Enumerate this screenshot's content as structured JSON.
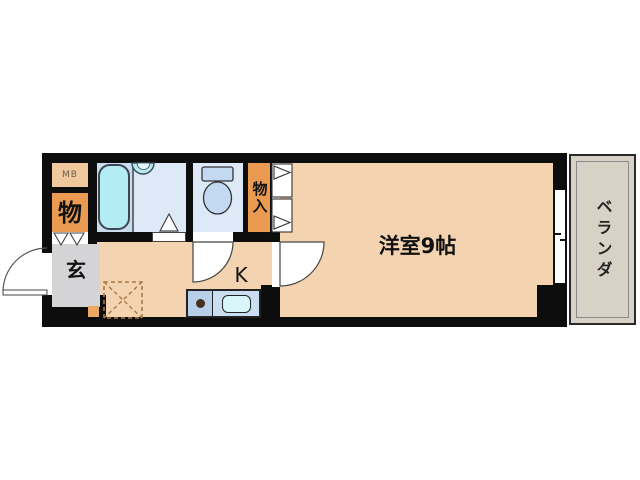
{
  "plan": {
    "type": "apartment-floorplan",
    "labels": {
      "meter_box": "MB",
      "storage": "物",
      "closet": "物入",
      "entrance": "玄",
      "kitchen": "K",
      "main_room": "洋室9帖",
      "veranda": "ベランダ"
    }
  },
  "colors": {
    "wall": "#0d0d0d",
    "floor": "#f3d3b0",
    "mb_box": "#f0c89e",
    "orange": "#eb9b51",
    "step_square": "#eba961",
    "genkan": "#d4d4d6",
    "bath_left": "#c9ddef",
    "bath_right": "#dde9f7",
    "fixture_cyan": "#b4ecf4",
    "fixture_blue": "#c3d9f2",
    "counter_left": "#b7cfe9",
    "counter_right": "#caddf1",
    "kitchen_sink": "#d8f5f9",
    "veranda_floor": "#d8d1c6",
    "dashed_box": "#a87948"
  }
}
